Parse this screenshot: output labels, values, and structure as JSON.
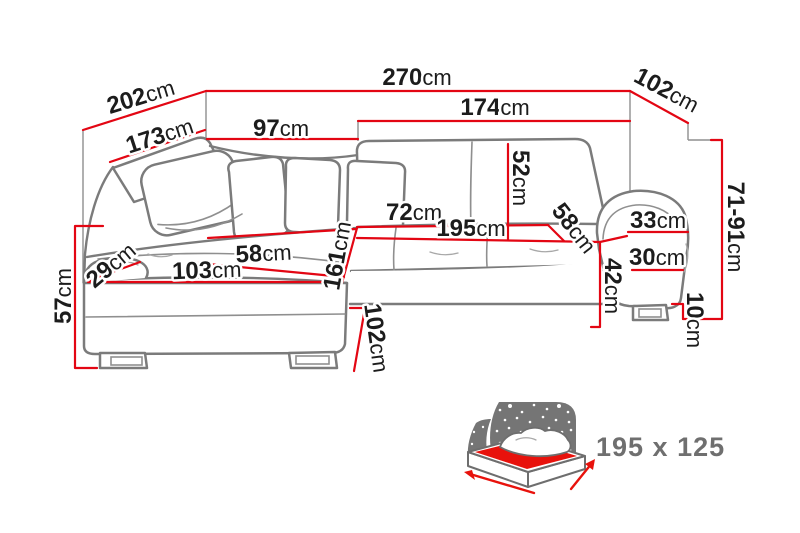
{
  "title": "Corner sofa dimension diagram",
  "unit": "cm",
  "labels": {
    "w270": {
      "num": "270",
      "unit": "cm"
    },
    "w202": {
      "num": "202",
      "unit": "cm"
    },
    "w173": {
      "num": "173",
      "unit": "cm"
    },
    "w97": {
      "num": "97",
      "unit": "cm"
    },
    "w174": {
      "num": "174",
      "unit": "cm"
    },
    "w102_top": {
      "num": "102",
      "unit": "cm"
    },
    "h52": {
      "num": "52",
      "unit": "cm"
    },
    "w72": {
      "num": "72",
      "unit": "cm"
    },
    "w195": {
      "num": "195",
      "unit": "cm"
    },
    "d58_right": {
      "num": "58",
      "unit": "cm"
    },
    "w33": {
      "num": "33",
      "unit": "cm"
    },
    "w30": {
      "num": "30",
      "unit": "cm"
    },
    "h71_91": {
      "num": "71-91",
      "unit": "cm"
    },
    "h10": {
      "num": "10",
      "unit": "cm"
    },
    "h42": {
      "num": "42",
      "unit": "cm"
    },
    "w58_left": {
      "num": "58",
      "unit": "cm"
    },
    "w103": {
      "num": "103",
      "unit": "cm"
    },
    "w29": {
      "num": "29",
      "unit": "cm"
    },
    "h161": {
      "num": "161",
      "unit": "cm"
    },
    "h57": {
      "num": "57",
      "unit": "cm"
    },
    "h102_bottom": {
      "num": "102",
      "unit": "cm"
    }
  },
  "sleeping_area": {
    "size": "195 x 125"
  },
  "colors": {
    "dimension_line": "#e30613",
    "label_text": "#1c1c1c",
    "sofa_outline": "#7b7b7b",
    "pictogram_gray": "#757575",
    "bed_highlight": "#e8120c",
    "sleeping_text": "#6f6f6f"
  }
}
